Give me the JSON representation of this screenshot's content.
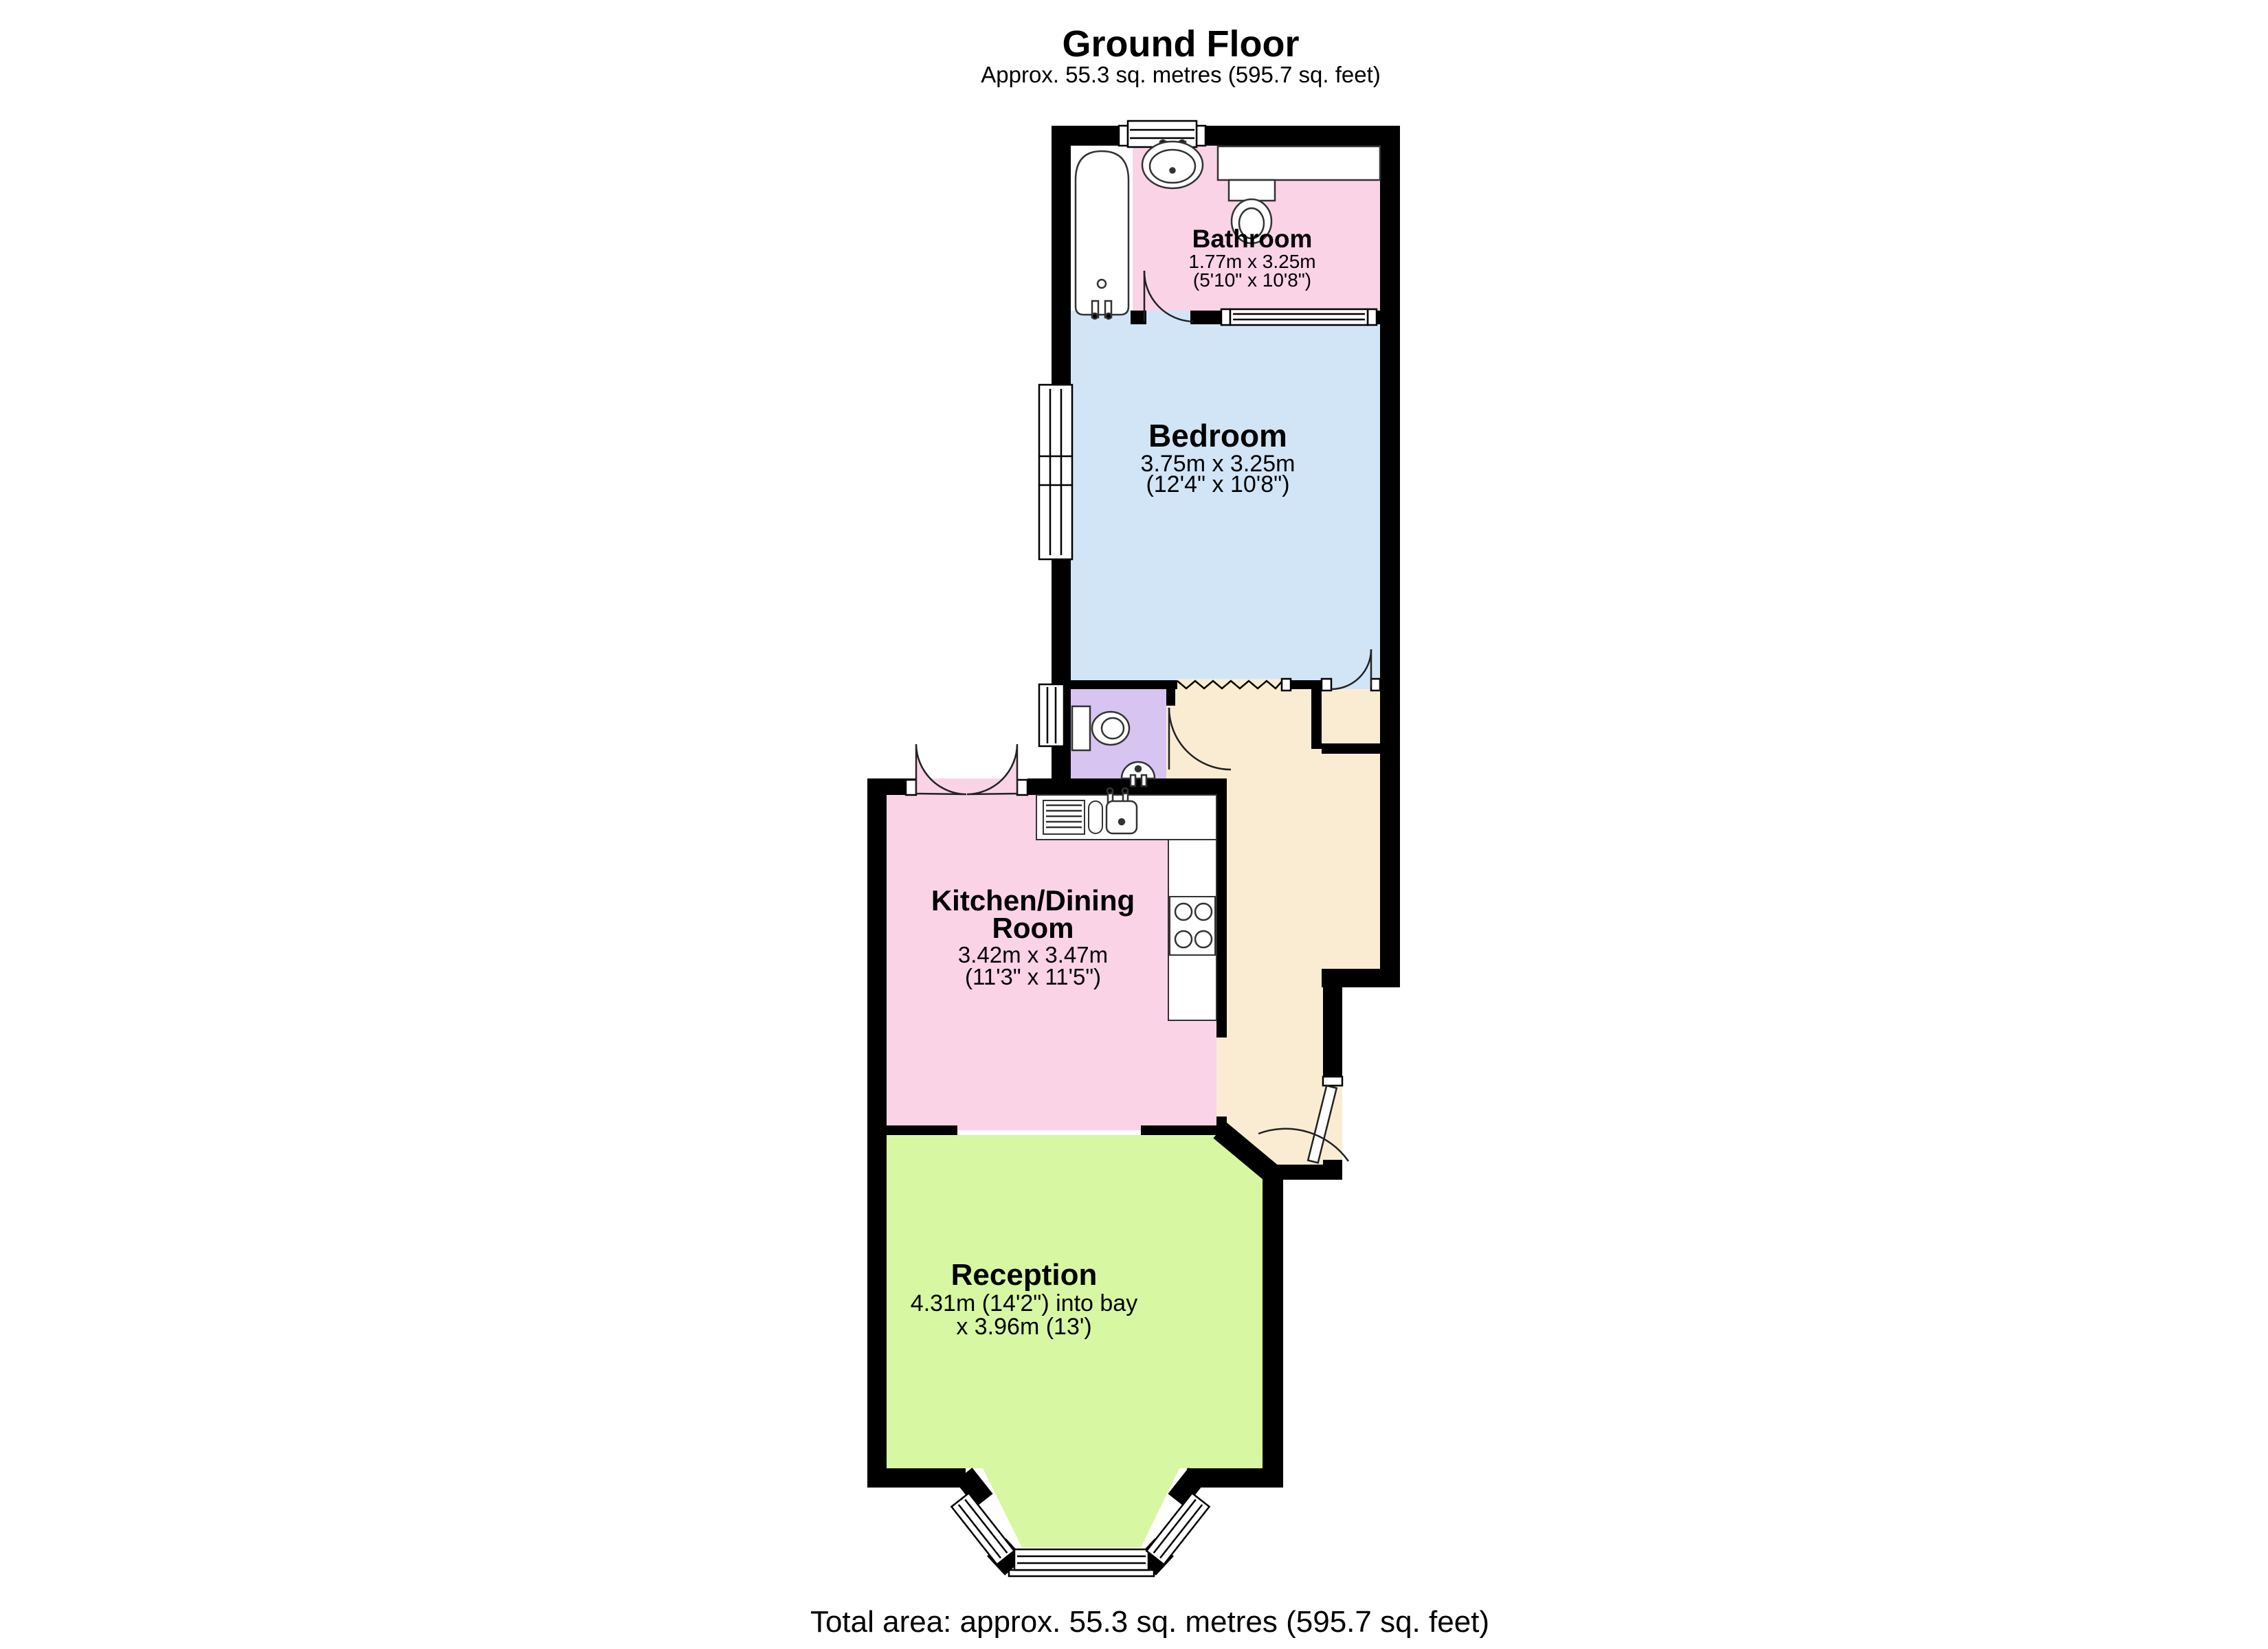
{
  "header": {
    "title": "Ground Floor",
    "subtitle": "Approx. 55.3 sq. metres (595.7 sq. feet)"
  },
  "footer": {
    "total_area": "Total area: approx. 55.3 sq. metres (595.7 sq. feet)"
  },
  "rooms": {
    "bathroom": {
      "name": "Bathroom",
      "dim_metric": "1.77m x 3.25m",
      "dim_imperial": "(5'10\" x 10'8\")"
    },
    "bedroom": {
      "name": "Bedroom",
      "dim_metric": "3.75m x 3.25m",
      "dim_imperial": "(12'4\" x 10'8\")"
    },
    "kitchen": {
      "name_line1": "Kitchen/Dining",
      "name_line2": "Room",
      "dim_metric": "3.42m x 3.47m",
      "dim_imperial": "(11'3\" x 11'5\")"
    },
    "reception": {
      "name": "Reception",
      "dim_line1": "4.31m (14'2\") into bay",
      "dim_line2": "x 3.96m (13')"
    }
  },
  "colors": {
    "bathroom": "#fad3e7",
    "bedroom": "#d2e5f7",
    "wc": "#d8c4f0",
    "hallway": "#faecd3",
    "kitchen": "#fad3e7",
    "reception": "#d7f7a2",
    "wall": "#000000",
    "fixture_stroke": "#333333"
  }
}
